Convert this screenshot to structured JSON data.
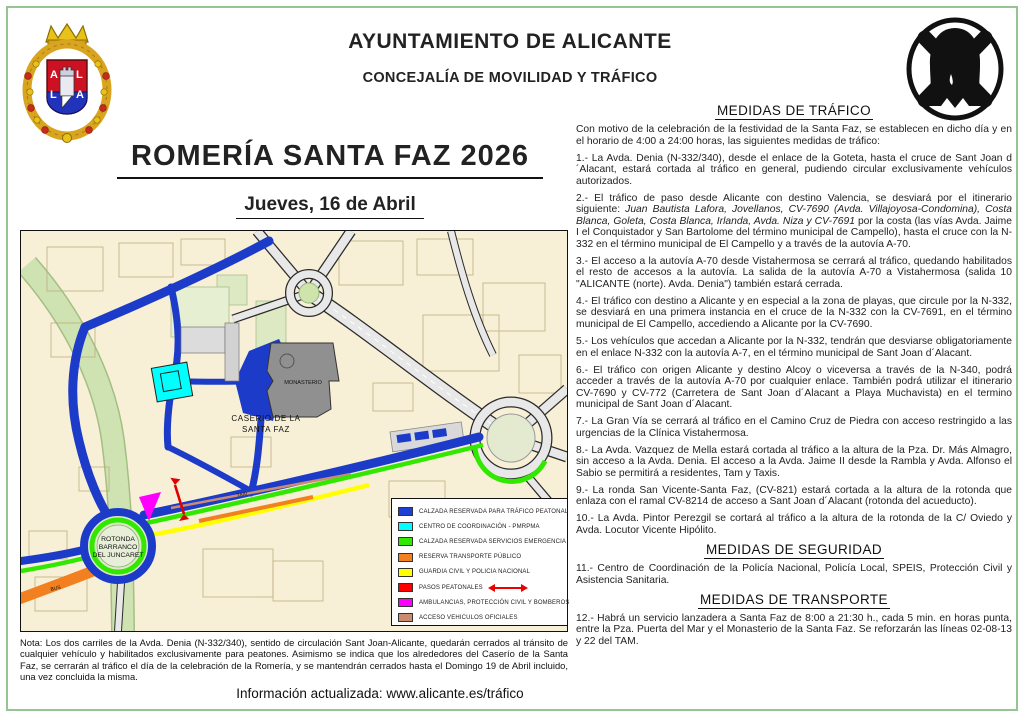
{
  "header": {
    "org": "AYUNTAMIENTO DE ALICANTE",
    "dept": "CONCEJALÍA DE MOVILIDAD Y TRÁFICO"
  },
  "title": "ROMERÍA SANTA FAZ 2026",
  "date": "Jueves, 16 de Abril",
  "traffic": {
    "heading": "MEDIDAS DE TRÁFICO",
    "intro": "Con motivo de la celebración de la festividad de la Santa Faz, se establecen en dicho día y en el horario de 4:00 a 24:00 horas, las siguientes medidas de tráfico:",
    "items": [
      "1.- La Avda. Denia (N-332/340), desde el enlace de la Goteta, hasta el cruce de Sant Joan d´Alacant, estará cortada al tráfico en general, pudiendo circular exclusivamente vehículos autorizados.",
      "2.- El tráfico de paso desde Alicante con destino Valencia, se desviará por el itinerario siguiente: <i>Juan Bautista Lafora, Jovellanos, CV-7690 (Avda. Villajoyosa-Condomina), Costa Blanca, Goleta, Costa Blanca, Irlanda, Avda. Niza y CV-7691</i> por la costa (las vías Avda. Jaime I el Conquistador y San Bartolome del término municipal de Campello), hasta el cruce con la N-332 en el término municipal de El Campello y a través de la autovía A-70.",
      "3.- El acceso a la autovía A-70 desde Vistahermosa se cerrará al tráfico, quedando habilitados el resto de accesos a la autovía. La salida de la autovía A-70 a Vistahermosa (salida 10 \"ALICANTE (norte). Avda. Denia\") también estará cerrada.",
      "4.- El tráfico con destino a Alicante y en especial a la zona de playas, que circule por la N-332, se desviará en una primera instancia en el cruce de la N-332 con la CV-7691, en el término municipal de El Campello, accediendo a Alicante por la CV-7690.",
      "5.- Los vehículos que accedan a Alicante por la N-332, tendrán que desviarse obligatoriamente en el enlace N-332 con la autovía A-7, en el término municipal de Sant Joan d´Alacant.",
      "6.- El tráfico con origen Alicante y destino Alcoy o viceversa a través de la N-340, podrá acceder a través de la autovía A-70 por cualquier enlace. También podrá utilizar el itinerario CV-7690 y CV-772 (Carretera de Sant Joan d´Alacant a Playa Muchavista) en el termino municipal de Sant Joan d´Alacant.",
      "7.- La Gran Vía se cerrará al tráfico en el Camino Cruz de Piedra con acceso restringido a las urgencias de la Clínica Vistahermosa.",
      "8.- La Avda. Vazquez de Mella estará cortada al  tráfico a la altura de la Pza. Dr. Más Almagro, sin acceso a la Avda. Denia. El acceso a la Avda. Jaime II desde la Rambla y Avda. Alfonso el Sabio se permitirá a residentes, Tam y Taxis.",
      "9.- La ronda San Vicente-Santa Faz, (CV-821) estará cortada a la altura de la rotonda que enlaza con el ramal CV-8214 de acceso a Sant Joan d´Alacant (rotonda del acueducto).",
      "10.- La Avda. Pintor Perezgil se cortará al tráfico a la altura de la rotonda de la C/ Oviedo y Avda. Locutor Vicente Hipólito."
    ]
  },
  "security": {
    "heading": "MEDIDAS DE SEGURIDAD",
    "items": [
      "11.- Centro de Coordinación de la Policía Nacional, Policía Local, SPEIS, Protección Civil y Asistencia Sanitaria."
    ]
  },
  "transport": {
    "heading": "MEDIDAS DE TRANSPORTE",
    "items": [
      "12.- Habrá un servicio lanzadera a Santa Faz de 8:00 a 21:30 h., cada 5 min. en horas punta, entre la Pza. Puerta del Mar y el Monasterio de la Santa Faz. Se reforzarán las líneas 02-08-13 y 22 del TAM."
    ]
  },
  "note": "Nota: Los dos carriles de la Avda. Denia (N-332/340), sentido de circulación Sant Joan-Alicante, quedarán cerrados al tránsito de cualquier vehículo y habilitados exclusivamente para peatones. Asimismo se indica que los alrededores del Caserío de la Santa Faz, se cerrarán al tráfico el día de la celebración de la Romería, y se mantendrán cerrados hasta el Domingo 19 de Abril incluido, una vez concluida la misma.",
  "info_line": "Información actualizada: www.alicante.es/tráfico",
  "map": {
    "labels": {
      "monasterio": "MONASTERIO",
      "caserio_line1": "CASERIO DE LA",
      "caserio_line2": "SANTA FAZ",
      "rotonda_line1": "ROTONDA",
      "rotonda_line2": "BARRANCO",
      "rotonda_line3": "DEL JUNCARET",
      "bus": "BUS",
      "taxi": "TAXI"
    },
    "legend": [
      {
        "color": "#1d3fd4",
        "label": "CALZADA RESERVADA PARA TRÁFICO PEATONAL"
      },
      {
        "color": "#00ffff",
        "label": "CENTRO DE COORDINACIÓN - PMRPMA"
      },
      {
        "color": "#33e800",
        "label": "CALZADA RESERVADA SERVICIOS EMERGENCIA"
      },
      {
        "color": "#f28020",
        "label": "RESERVA TRANSPORTE PÚBLICO"
      },
      {
        "color": "#ffff00",
        "label": "GUARDIA CIVIL Y POLICIA NACIONAL"
      },
      {
        "color": "#ff0000",
        "label": "PASOS PEATONALES",
        "arrow": true
      },
      {
        "color": "#ff00ff",
        "label": "AMBULANCIAS, PROTECCIÓN CIVIL Y BOMBEROS"
      },
      {
        "color": "#c98b72",
        "label": "ACCESO VEHICULOS OFICIALES"
      }
    ]
  },
  "colors": {
    "page_border": "#95c594",
    "pedestrian_blue": "#1d3bc9",
    "emergency_green": "#33e800",
    "bus_orange": "#f28020",
    "police_yellow": "#ffff00",
    "crossing_red": "#ff0000",
    "ambulance_magenta": "#ff00ff",
    "official_salmon": "#c98b72",
    "map_background": "#f7efd6"
  }
}
